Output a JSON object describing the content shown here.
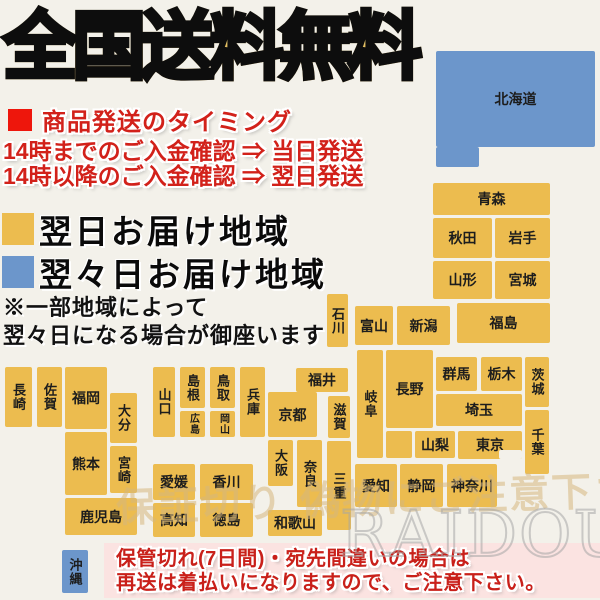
{
  "title": "全国送料無料",
  "timing": {
    "heading": "商品発送のタイミング",
    "line1": "14時までのご入金確認 ⇒ 当日発送",
    "line2": "14時以降のご入金確認 ⇒ 翌日発送"
  },
  "legend": {
    "next_day": {
      "label": "翌日お届け地域",
      "color": "#ECBC4F"
    },
    "second_day": {
      "label": "翌々日お届け地域",
      "color": "#6C96CB"
    }
  },
  "note": {
    "line1": "※一部地域によって",
    "line2": "翌々日になる場合が御座います"
  },
  "footer": {
    "line1": "保管切れ(7日間)・宛先間違いの場合は",
    "line2": "再送は着払いになりますので、ご注意下さい。"
  },
  "watermarks": {
    "caution": "保証切り 偽物にご注意下さい",
    "brand": "RAIDOU"
  },
  "colors": {
    "orange": "#ECBC4F",
    "blue": "#6C96CB",
    "bg": "#F3F1EA",
    "red": "#D2211A",
    "footer_bg": "#FBE3E1",
    "title_gold": "#D8A94C"
  },
  "map": {
    "blocks": [
      {
        "name": "北海道",
        "x": 436,
        "y": 51,
        "w": 159,
        "h": 96,
        "color": "blue"
      },
      {
        "name": "",
        "x": 436,
        "y": 147,
        "w": 43,
        "h": 20,
        "color": "blue"
      },
      {
        "name": "青森",
        "x": 433,
        "y": 183,
        "w": 117,
        "h": 32,
        "color": "orange"
      },
      {
        "name": "秋田",
        "x": 433,
        "y": 218,
        "w": 59,
        "h": 40,
        "color": "orange"
      },
      {
        "name": "岩手",
        "x": 495,
        "y": 218,
        "w": 55,
        "h": 40,
        "color": "orange"
      },
      {
        "name": "山形",
        "x": 433,
        "y": 261,
        "w": 59,
        "h": 38,
        "color": "orange"
      },
      {
        "name": "宮城",
        "x": 495,
        "y": 261,
        "w": 55,
        "h": 38,
        "color": "orange"
      },
      {
        "name": "福島",
        "x": 457,
        "y": 303,
        "w": 93,
        "h": 40,
        "color": "orange"
      },
      {
        "name": "新潟",
        "x": 397,
        "y": 306,
        "w": 53,
        "h": 39,
        "color": "orange"
      },
      {
        "name": "富山",
        "x": 355,
        "y": 306,
        "w": 38,
        "h": 39,
        "color": "orange"
      },
      {
        "name": "石川",
        "x": 327,
        "y": 294,
        "w": 21,
        "h": 53,
        "color": "orange",
        "v": true
      },
      {
        "name": "福井",
        "x": 296,
        "y": 368,
        "w": 52,
        "h": 24,
        "color": "orange"
      },
      {
        "name": "群馬",
        "x": 436,
        "y": 357,
        "w": 41,
        "h": 34,
        "color": "orange"
      },
      {
        "name": "栃木",
        "x": 481,
        "y": 357,
        "w": 41,
        "h": 34,
        "color": "orange"
      },
      {
        "name": "茨城",
        "x": 525,
        "y": 357,
        "w": 24,
        "h": 50,
        "color": "orange",
        "v": true
      },
      {
        "name": "埼玉",
        "x": 436,
        "y": 394,
        "w": 86,
        "h": 32,
        "color": "orange"
      },
      {
        "name": "長野",
        "x": 386,
        "y": 350,
        "w": 47,
        "h": 78,
        "color": "orange"
      },
      {
        "name": "",
        "x": 386,
        "y": 431,
        "w": 26,
        "h": 27,
        "color": "orange"
      },
      {
        "name": "岐阜",
        "x": 357,
        "y": 350,
        "w": 26,
        "h": 108,
        "color": "orange",
        "v": true
      },
      {
        "name": "山梨",
        "x": 415,
        "y": 431,
        "w": 40,
        "h": 27,
        "color": "orange"
      },
      {
        "name": "東京",
        "x": 458,
        "y": 431,
        "w": 64,
        "h": 28,
        "color": "orange"
      },
      {
        "name": "",
        "x": 499,
        "y": 450,
        "w": 23,
        "h": 9,
        "color": "bg"
      },
      {
        "name": "千葉",
        "x": 525,
        "y": 410,
        "w": 24,
        "h": 64,
        "color": "orange",
        "v": true
      },
      {
        "name": "神奈川",
        "x": 447,
        "y": 464,
        "w": 50,
        "h": 43,
        "color": "orange"
      },
      {
        "name": "静岡",
        "x": 400,
        "y": 464,
        "w": 43,
        "h": 43,
        "color": "orange"
      },
      {
        "name": "愛知",
        "x": 355,
        "y": 464,
        "w": 42,
        "h": 43,
        "color": "orange"
      },
      {
        "name": "三重",
        "x": 327,
        "y": 441,
        "w": 24,
        "h": 89,
        "color": "orange",
        "v": true
      },
      {
        "name": "滋賀",
        "x": 328,
        "y": 396,
        "w": 22,
        "h": 42,
        "color": "orange",
        "v": true
      },
      {
        "name": "京都",
        "x": 268,
        "y": 392,
        "w": 49,
        "h": 45,
        "color": "orange"
      },
      {
        "name": "大阪",
        "x": 268,
        "y": 440,
        "w": 25,
        "h": 46,
        "color": "orange",
        "v": true
      },
      {
        "name": "奈良",
        "x": 297,
        "y": 440,
        "w": 25,
        "h": 67,
        "color": "orange",
        "v": true
      },
      {
        "name": "和歌山",
        "x": 268,
        "y": 510,
        "w": 54,
        "h": 26,
        "color": "orange"
      },
      {
        "name": "兵庫",
        "x": 240,
        "y": 367,
        "w": 25,
        "h": 70,
        "color": "orange",
        "v": true
      },
      {
        "name": "鳥取",
        "x": 210,
        "y": 367,
        "w": 25,
        "h": 41,
        "color": "orange",
        "v": true
      },
      {
        "name": "島根",
        "x": 180,
        "y": 367,
        "w": 25,
        "h": 41,
        "color": "orange",
        "v": true
      },
      {
        "name": "岡山",
        "x": 210,
        "y": 411,
        "w": 25,
        "h": 26,
        "color": "orange",
        "v": true
      },
      {
        "name": "広島",
        "x": 180,
        "y": 411,
        "w": 25,
        "h": 26,
        "color": "orange",
        "v": true
      },
      {
        "name": "山口",
        "x": 153,
        "y": 367,
        "w": 22,
        "h": 70,
        "color": "orange",
        "v": true
      },
      {
        "name": "香川",
        "x": 200,
        "y": 464,
        "w": 53,
        "h": 36,
        "color": "orange"
      },
      {
        "name": "愛媛",
        "x": 153,
        "y": 464,
        "w": 42,
        "h": 36,
        "color": "orange"
      },
      {
        "name": "徳島",
        "x": 200,
        "y": 503,
        "w": 53,
        "h": 34,
        "color": "orange"
      },
      {
        "name": "高知",
        "x": 153,
        "y": 503,
        "w": 42,
        "h": 34,
        "color": "orange"
      },
      {
        "name": "福岡",
        "x": 65,
        "y": 367,
        "w": 42,
        "h": 62,
        "color": "orange"
      },
      {
        "name": "佐賀",
        "x": 37,
        "y": 367,
        "w": 25,
        "h": 60,
        "color": "orange",
        "v": true
      },
      {
        "name": "長崎",
        "x": 5,
        "y": 367,
        "w": 27,
        "h": 60,
        "color": "orange",
        "v": true
      },
      {
        "name": "大分",
        "x": 110,
        "y": 393,
        "w": 27,
        "h": 50,
        "color": "orange",
        "v": true
      },
      {
        "name": "熊本",
        "x": 65,
        "y": 432,
        "w": 42,
        "h": 63,
        "color": "orange"
      },
      {
        "name": "宮崎",
        "x": 110,
        "y": 446,
        "w": 27,
        "h": 47,
        "color": "orange",
        "v": true
      },
      {
        "name": "鹿児島",
        "x": 65,
        "y": 498,
        "w": 72,
        "h": 37,
        "color": "orange"
      },
      {
        "name": "沖縄",
        "x": 62,
        "y": 550,
        "w": 26,
        "h": 43,
        "color": "blue",
        "v": true
      }
    ]
  }
}
